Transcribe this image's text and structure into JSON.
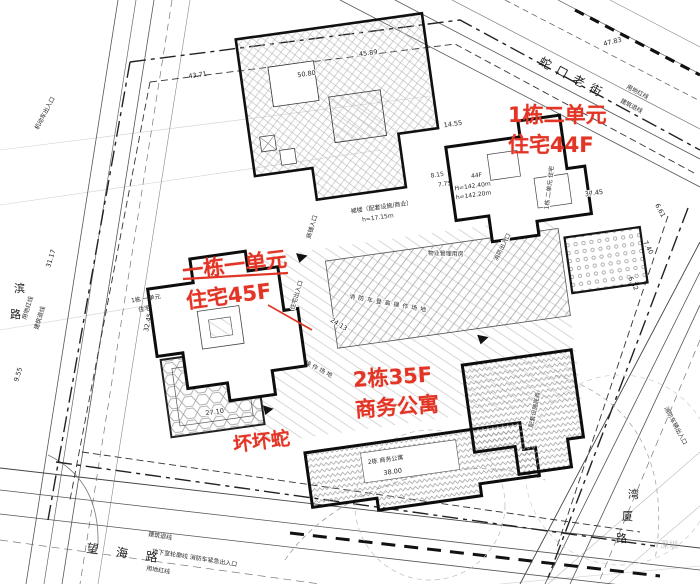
{
  "annotations": {
    "color": "#e23526",
    "b1u2": {
      "line1": "1栋二单元",
      "line2": "住宅44F"
    },
    "b1u1": {
      "line1": "一栋一单元",
      "line2": "住宅45F"
    },
    "b2": {
      "line1": "2栋35F",
      "line2": "商务公寓"
    },
    "signature": "坏坏蛇"
  },
  "roads": {
    "top": "蛇口老街",
    "bottom": "望 海 路",
    "left_chars": [
      "滨",
      "路"
    ],
    "right_chars": [
      "湾",
      "厦",
      "路"
    ]
  },
  "boundary": {
    "redline": "用地红线",
    "setback": "建筑退线",
    "basement": "地下室轮廓线 消防车紧急出入口"
  },
  "site": {
    "fire_lane": "消防车登高操作场地",
    "podium": "裙楼（配套设施/商业）",
    "podium_height": "h=17.15m",
    "b1u2_floors": "44F",
    "b1u2_H": "H=142.40m",
    "b1u2_h": "h=142.20m",
    "b1u2_name": "1栋 二单元 住宅",
    "b1u1_name": "1栋 一单元",
    "b1u1_use": "住宅",
    "b2_name": "2栋 商务公寓",
    "wing_name": "配套设施底商",
    "pm_house": "物业管理用房",
    "shop_entry": "商铺入口",
    "res_entry": "住宅出入口",
    "fire_entry": "消防出入口",
    "veh_entry": "机动车出入口",
    "fire_veh_entry": "消防车辆出入口"
  },
  "dims": {
    "a": "47.83",
    "b": "43.71",
    "c": "50.80",
    "d": "45.89",
    "e": "14.55",
    "f": "8.15",
    "g": "7.75",
    "h": "37.45",
    "i": "27.10",
    "j": "38.00",
    "k": "24.13",
    "l": "31.17",
    "m": "9.55",
    "n": "6.61",
    "o": "6.32",
    "p": "7.40",
    "q": "32.45"
  },
  "watermark": {
    "city": "深圳"
  }
}
